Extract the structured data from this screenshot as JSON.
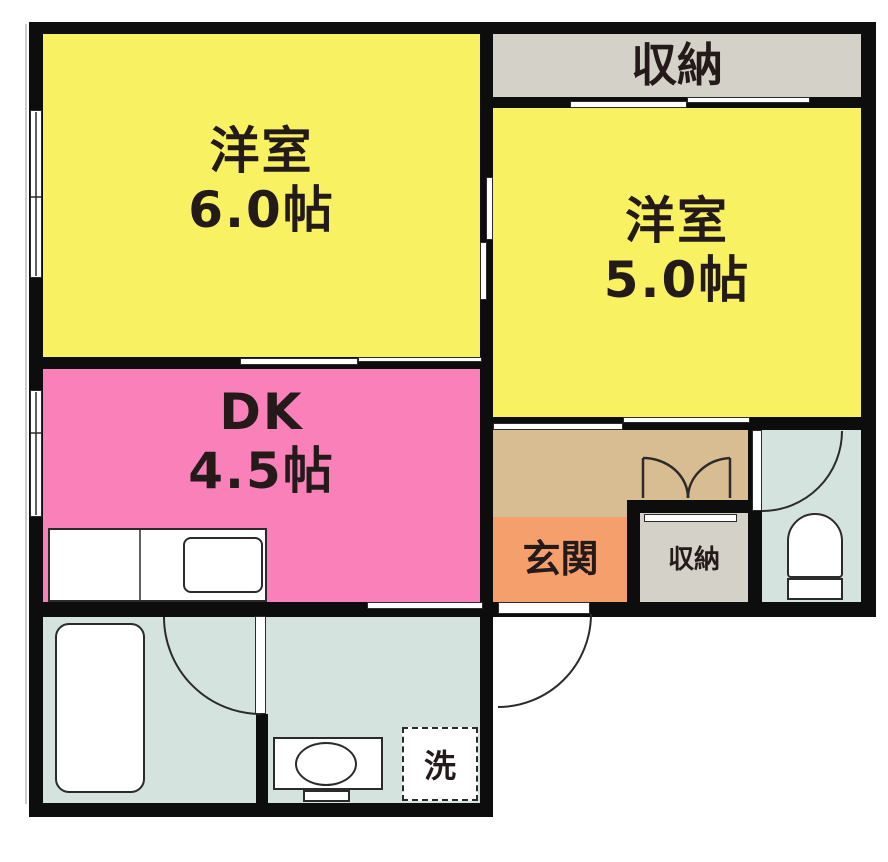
{
  "title": "apartment-floor-plan",
  "labels": {
    "room6_name": "洋室",
    "room6_size": "6.0帖",
    "room5_name": "洋室",
    "room5_size": "5.0帖",
    "dk_name": "DK",
    "dk_size": "4.5帖",
    "closet_top": "収納",
    "genkan": "玄関",
    "closet_hall": "収納",
    "laundry": "洗"
  },
  "colors": {
    "yellow": "#F8F262",
    "pink": "#F980B8",
    "orange": "#F5A06C",
    "tan": "#D9BD92",
    "gray": "#D4D1C8",
    "blue": "#D5E3DF",
    "wall": "#0D0D0D",
    "ink": "#241a1a"
  }
}
